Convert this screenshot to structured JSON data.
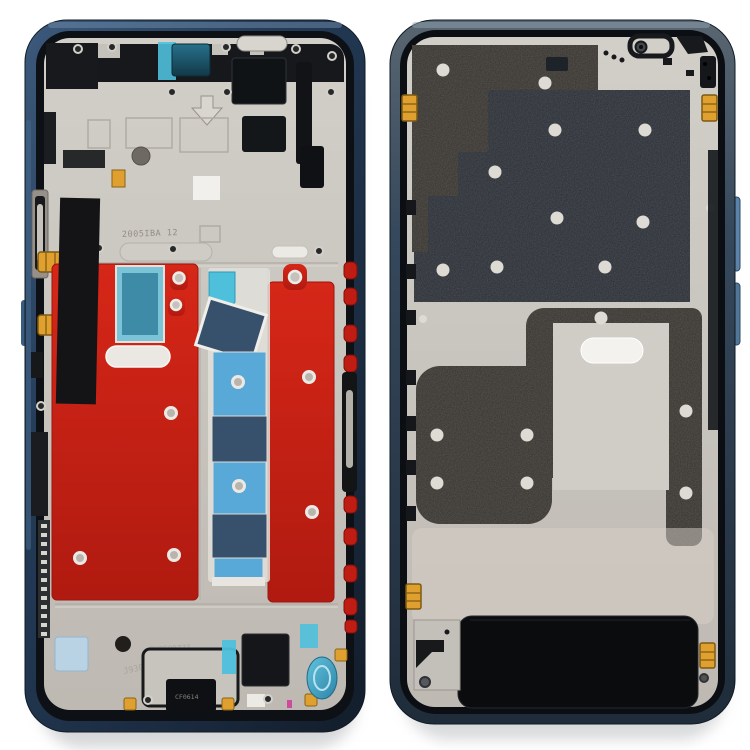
{
  "window": {
    "background": "#ffffff"
  },
  "colors": {
    "frame_navy": "#24384f",
    "frame_navy_dark": "#16222e",
    "frame_highlight": "#52718f",
    "silver": "#c9c5bf",
    "silver_bright": "#e8e5e0",
    "graphite": "#34312d",
    "smooth_plate": "#262b33",
    "red_adhesive": "#c92118",
    "tape_light_blue": "#58a8d8",
    "tape_navy": "#37506c",
    "tape_cyan": "#4fc0dc",
    "teal_window": "#1b5668",
    "gold": "#dfa02f",
    "pale_blue_pad": "#b9d3e4",
    "coil_blue": "#3fa8c8",
    "black_part": "#15171a",
    "white_part": "#f2f0ec",
    "screw_grey": "#b5b1ab",
    "side_button_blue": "#5b82a8",
    "side_button_red": "#bf1d13",
    "shadow": "#b3b6b8"
  },
  "front_view": {
    "stamps": {
      "plate_code": "2005IBA 12",
      "mold_code": "3U0609ZZZ",
      "serial_code": "J9300414",
      "connector_code": "CF0614"
    }
  }
}
